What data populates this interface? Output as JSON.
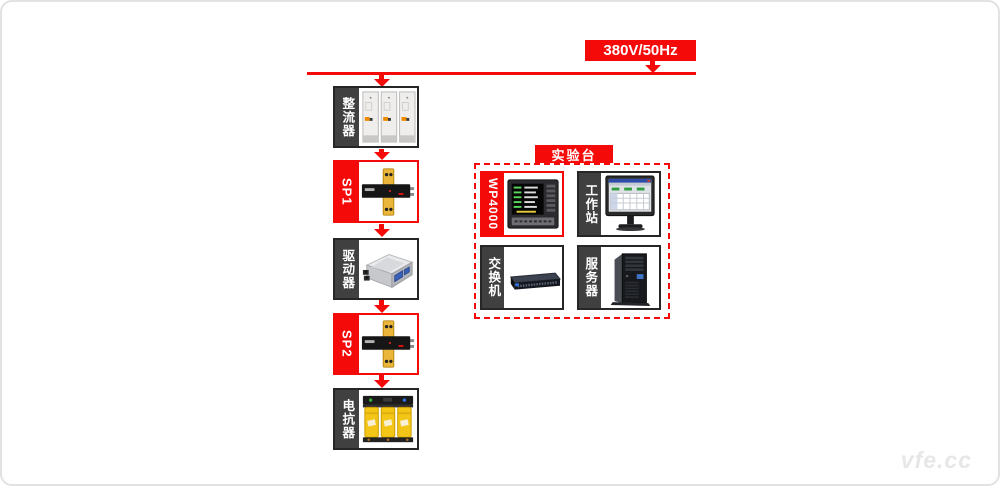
{
  "power_source": {
    "label": "380V/50Hz"
  },
  "chain": [
    {
      "label": "整流器",
      "kind": "rectifier"
    },
    {
      "label": "SP1",
      "kind": "sp-transducer"
    },
    {
      "label": "驱动器",
      "kind": "driver"
    },
    {
      "label": "SP2",
      "kind": "sp-transducer"
    },
    {
      "label": "电抗器",
      "kind": "reactor"
    }
  ],
  "test_bench": {
    "title": "实验台",
    "items": [
      {
        "label": "WP4000",
        "kind": "power-analyzer"
      },
      {
        "label": "工作站",
        "kind": "workstation-monitor"
      },
      {
        "label": "交换机",
        "kind": "network-switch"
      },
      {
        "label": "服务器",
        "kind": "tower-server"
      }
    ]
  },
  "watermark": "vfe.cc",
  "colors": {
    "accent_red": "#f50a0a",
    "strip_dark": "#404040",
    "highlight_border": "#f50a0a"
  }
}
